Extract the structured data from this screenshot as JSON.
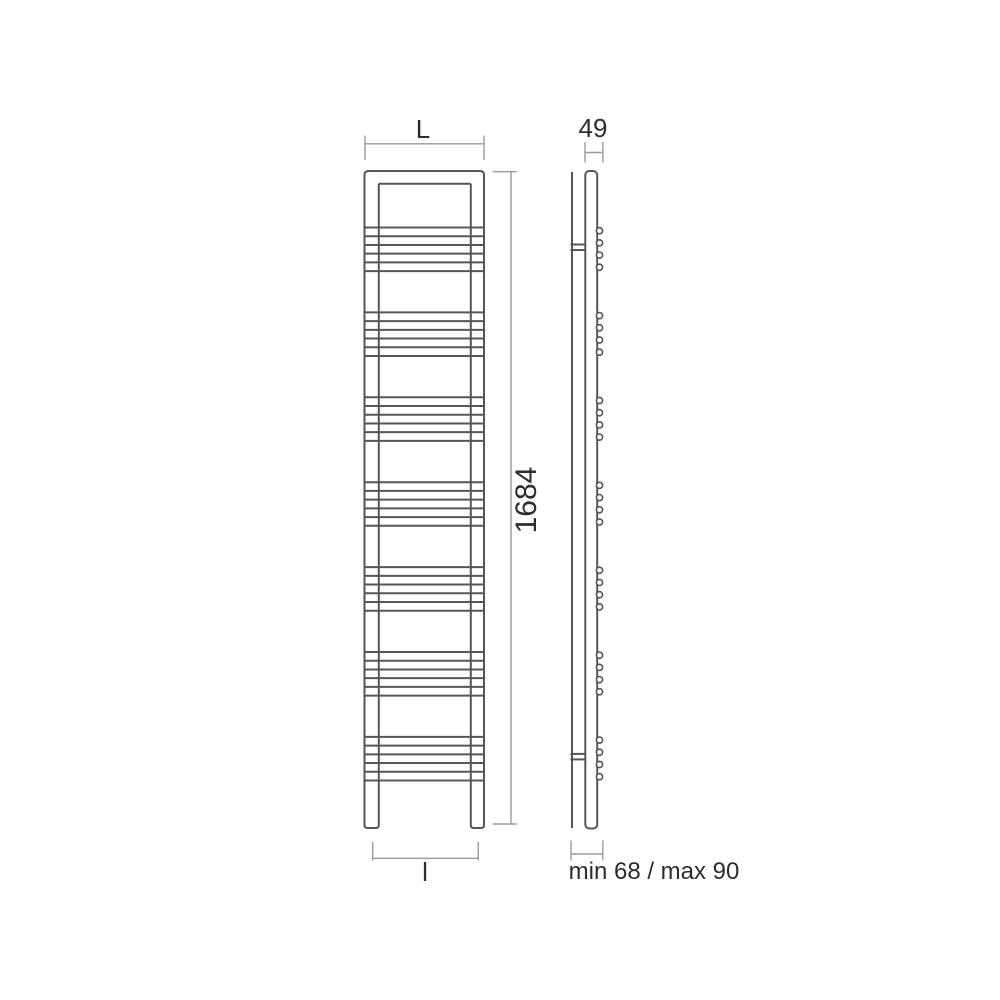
{
  "drawing": {
    "type": "technical-dimension-drawing",
    "subject": "ladder towel radiator, front and side elevation",
    "colors": {
      "background": "#ffffff",
      "object_line": "#565656",
      "dimension_line": "#9b9b9b",
      "text": "#2d2d2d"
    },
    "front_view": {
      "rung_groups": 7,
      "bars_per_group": 6,
      "vertical_tubes": 2,
      "legs": 2
    },
    "side_view": {
      "hook_groups": 7,
      "circles_per_group": 4,
      "wall_brackets": 2
    },
    "dimensions": {
      "width_label": "L",
      "depth_label": "49",
      "height_label": "1684",
      "foot_spacing_label": "l",
      "wall_distance_label": "min 68 / max 90"
    }
  }
}
